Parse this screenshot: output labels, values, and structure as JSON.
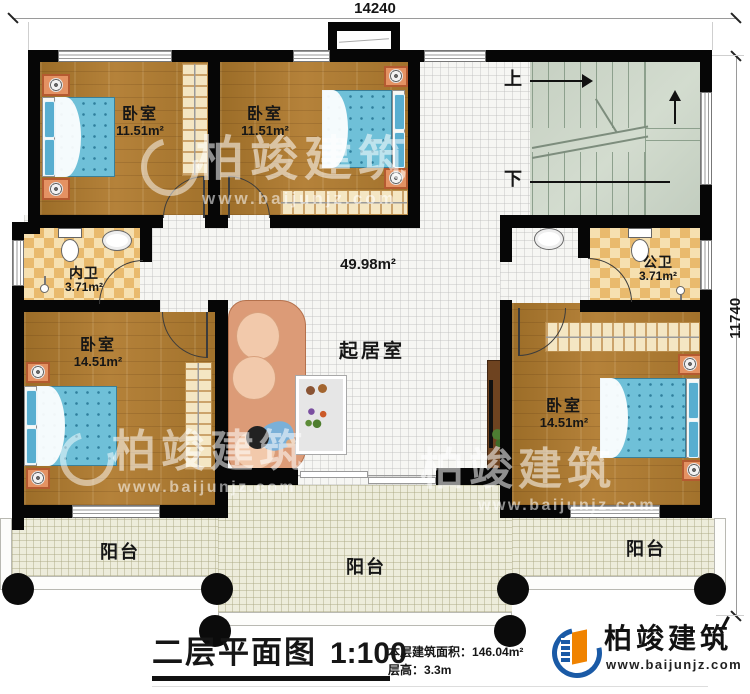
{
  "dimensions": {
    "top": "14240",
    "right": "11740"
  },
  "rooms": {
    "bedroom_tl": {
      "name": "卧室",
      "area": "11.51m²"
    },
    "bedroom_tm": {
      "name": "卧室",
      "area": "11.51m²"
    },
    "bedroom_bl": {
      "name": "卧室",
      "area": "14.51m²"
    },
    "bedroom_br": {
      "name": "卧室",
      "area": "14.51m²"
    },
    "bath_inner": {
      "name": "内卫",
      "area": "3.71m²"
    },
    "bath_public": {
      "name": "公卫",
      "area": "3.71m²"
    },
    "living": {
      "name": "起居室",
      "area": "49.98m²"
    },
    "balcony_left": "阳台",
    "balcony_center": "阳台",
    "balcony_right": "阳台",
    "stairs_up": "上",
    "stairs_down": "下"
  },
  "titleblock": {
    "title": "二层平面图",
    "scale": "1:100",
    "area_label": "本层建筑面积：",
    "area_value": "146.04m²",
    "floor_height_label": "层高：",
    "floor_height_value": "3.3m"
  },
  "brand": {
    "name": "柏竣建筑",
    "url": "www.baijunjz.com"
  },
  "watermark": {
    "name": "柏竣建筑",
    "url": "www.baijunjz.com"
  },
  "colors": {
    "wall": "#060606",
    "wood_floor": "#a87730",
    "tile_floor": "#f6f6f3",
    "bath_checker": "#e9ba6d",
    "stairs": "#cbd4c6",
    "balcony": "#edecdb",
    "mattress": "#6fc0d8",
    "brand_blue": "#1a5aa6",
    "brand_orange": "#f08300"
  }
}
